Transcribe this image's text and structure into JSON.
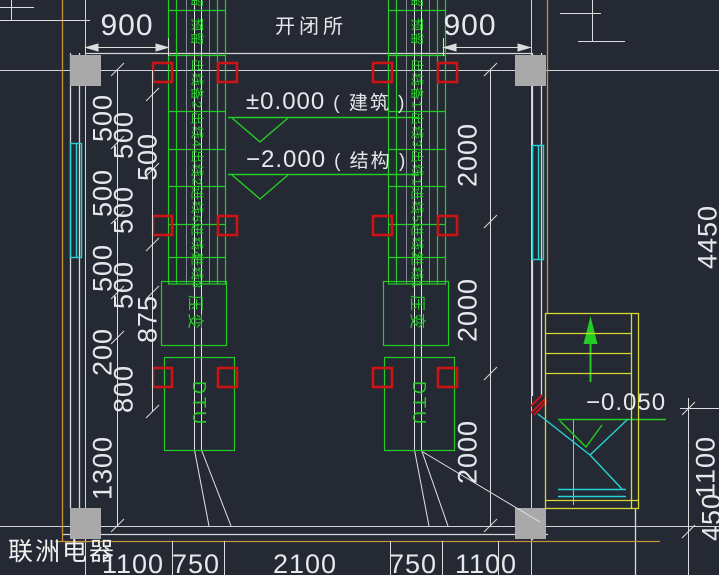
{
  "title": "开闭所",
  "company": "联洲电器",
  "elev": {
    "building": {
      "value": "±0.000",
      "note": "( 建筑 )"
    },
    "structure": {
      "value": "−2.000",
      "note": "( 结构 )"
    },
    "floor": "−0.050"
  },
  "panels": {
    "left": {
      "cells": [
        "预留",
        "预留",
        "出线备2",
        "出线4",
        "出线2",
        "进线6",
        "进线4",
        "进线3"
      ],
      "pt": "压变",
      "dtu": "DTU"
    },
    "right": {
      "cells": [
        "预留",
        "预留",
        "出线备1",
        "出线3",
        "出线1",
        "进线5",
        "进线2",
        "进线1"
      ],
      "pt": "压变",
      "dtu": "DTU"
    }
  },
  "dims": {
    "top_left": "900",
    "top_right": "900",
    "left_col1": [
      "500",
      "500",
      "500",
      "200",
      "1300"
    ],
    "left_col2": [
      "500",
      "500",
      "500",
      "800"
    ],
    "left_col3": [
      "500",
      "875"
    ],
    "right_inner": [
      "2000",
      "2000",
      "2000"
    ],
    "far_right": [
      "4450",
      "1100",
      "450"
    ],
    "bottom": [
      "1100",
      "750",
      "2100",
      "750",
      "1100"
    ]
  },
  "colors": {
    "background": "#242933",
    "dim_text": "#e6e9ec",
    "green": "#25cc25",
    "cyan": "#27d3d3",
    "yellow": "#d8d832",
    "orange": "#c7923a",
    "red": "#cc1414",
    "column_gray": "#a9a9a9"
  }
}
